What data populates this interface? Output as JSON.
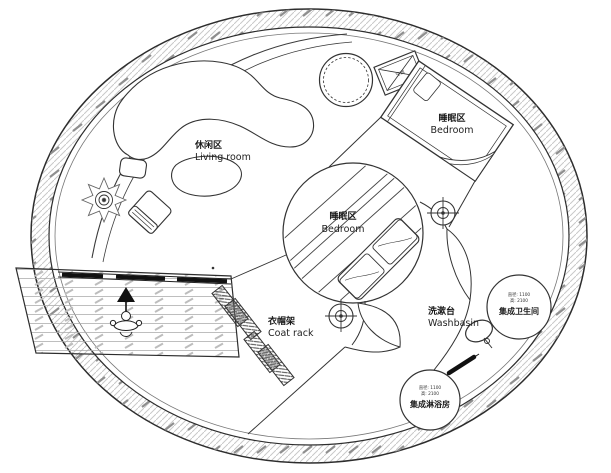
{
  "plan": {
    "type": "circular-tiny-house-floor-plan",
    "labels": {
      "living_room": {
        "zh": "休闲区",
        "en": "Living room"
      },
      "bedroom_top": {
        "zh": "睡眠区",
        "en": "Bedroom"
      },
      "bedroom_center": {
        "zh": "睡眠区",
        "en": "Bedroom"
      },
      "coat_rack": {
        "zh": "衣帽架",
        "en": "Coat rack"
      },
      "washbasin": {
        "zh": "洗漱台",
        "en": "Washbasin"
      }
    },
    "pods": {
      "toilet": {
        "dim1": "直径: 1100",
        "dim2": "高: 2100",
        "name": "集成卫生间"
      },
      "shower": {
        "dim1": "直径: 1100",
        "dim2": "高: 2100",
        "name": "集成淋浴房"
      }
    },
    "equipment": {
      "ac_label": "空调"
    },
    "colors": {
      "line": "#333333",
      "hatch_light": "#c4c4c4",
      "hatch_dark": "#8f8f8f",
      "background": "#ffffff",
      "solid_black": "#111111"
    }
  }
}
